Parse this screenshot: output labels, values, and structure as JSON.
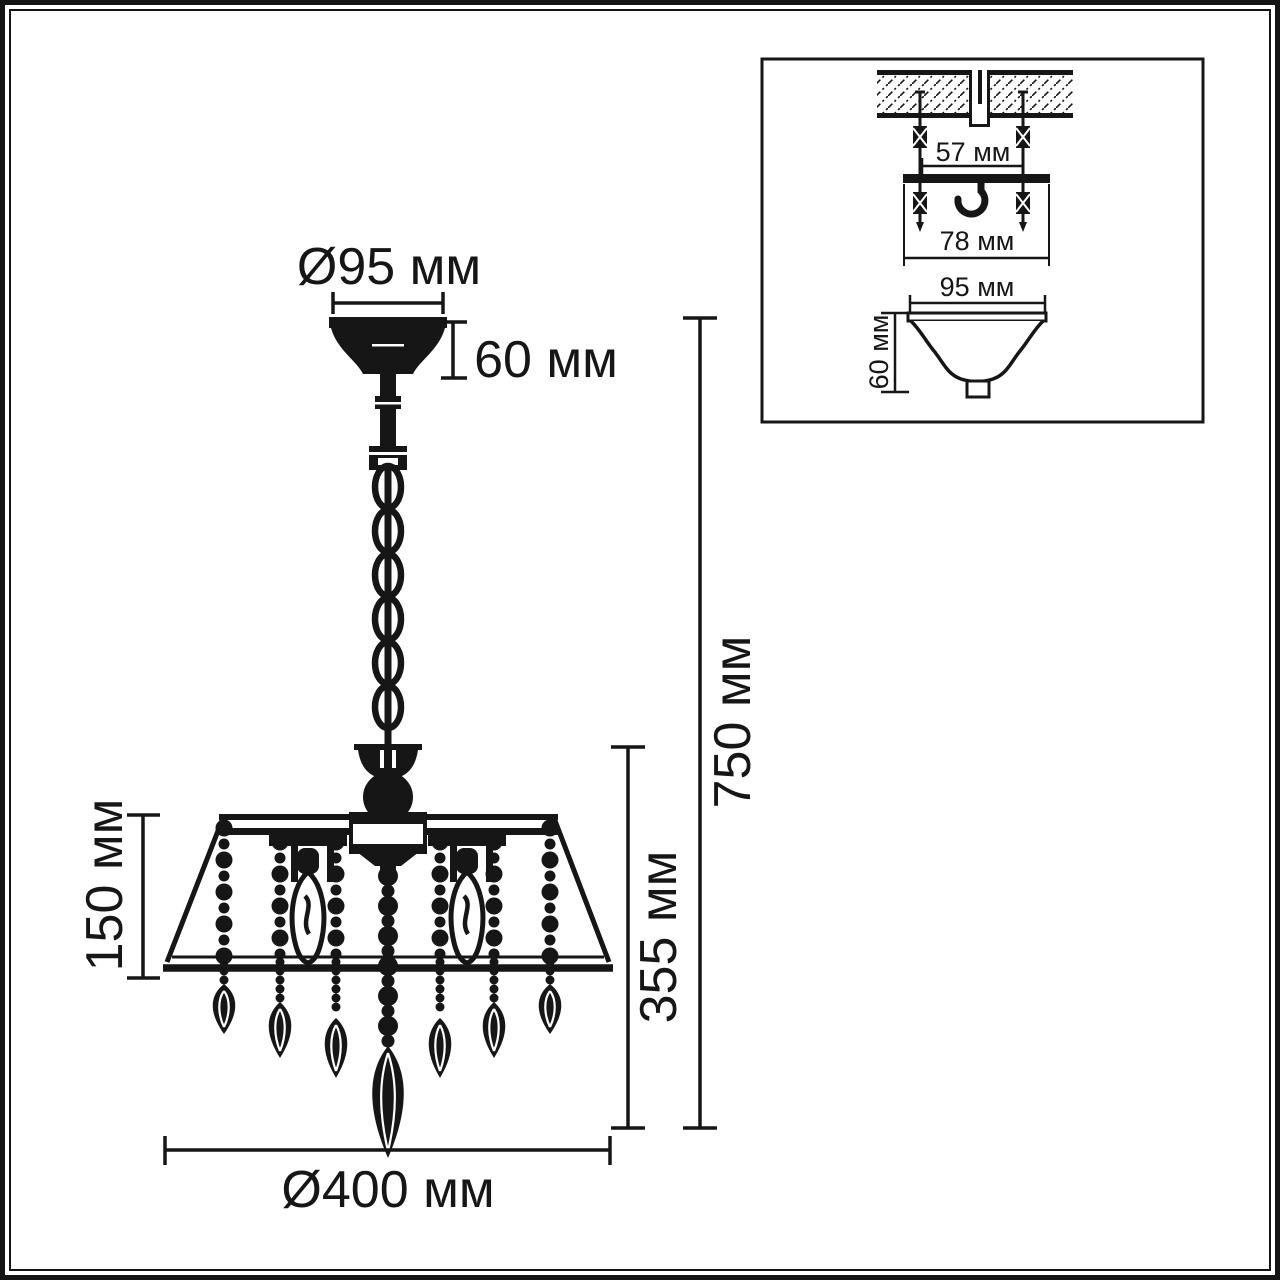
{
  "figure": {
    "type": "technical dimensional drawing",
    "subject": "chandelier pendant light with crystal drops, mounting detail inset",
    "units": "мм"
  },
  "dimensions": {
    "canopy_diameter": "Ø95 мм",
    "canopy_height": "60 мм",
    "overall_height": "750 мм",
    "body_height": "355 мм",
    "shade_height": "150 мм",
    "body_diameter": "Ø400 мм"
  },
  "inset": {
    "screw_spacing": "57 мм",
    "bracket_width": "78 мм",
    "canopy_diameter": "95 мм",
    "canopy_height": "60 мм"
  },
  "colors": {
    "ink": "#161616",
    "background": "#ffffff"
  }
}
